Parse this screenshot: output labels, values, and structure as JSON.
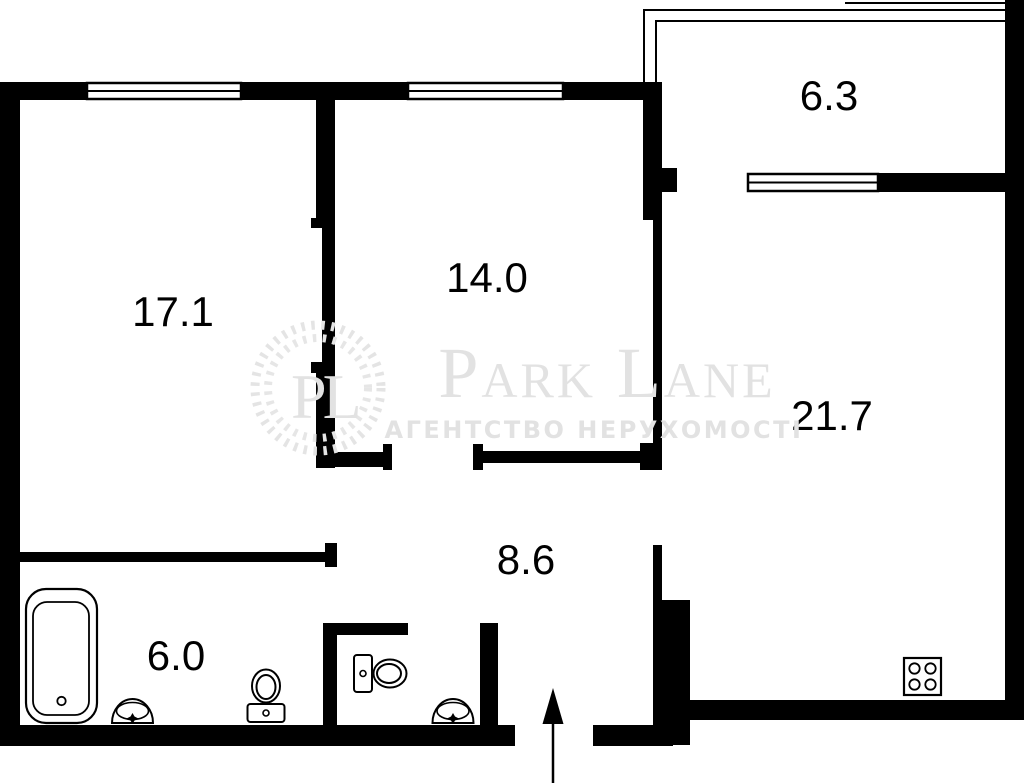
{
  "floor_plan": {
    "type": "apartment-floor-plan",
    "colors": {
      "wall": "#000000",
      "background": "#ffffff",
      "watermark": "#e4e4e4"
    },
    "rooms": [
      {
        "id": "bedroom-1",
        "area": "17.1"
      },
      {
        "id": "bedroom-2",
        "area": "14.0"
      },
      {
        "id": "balcony",
        "area": "6.3"
      },
      {
        "id": "living-kitchen",
        "area": "21.7"
      },
      {
        "id": "hallway",
        "area": "8.6"
      },
      {
        "id": "bathroom",
        "area": "6.0"
      }
    ],
    "fixtures": [
      "bathtub-icon",
      "sink-icon",
      "toilet-icon",
      "wc-toilet-icon",
      "wc-sink-icon",
      "stove-icon",
      "entrance-arrow-icon",
      "window-icon"
    ],
    "watermark": {
      "monogram": "PL",
      "brand": "Park Lane",
      "tagline": "АГЕНТСТВО НЕРУХОМОСТІ",
      "color": "#e4e4e4"
    }
  }
}
